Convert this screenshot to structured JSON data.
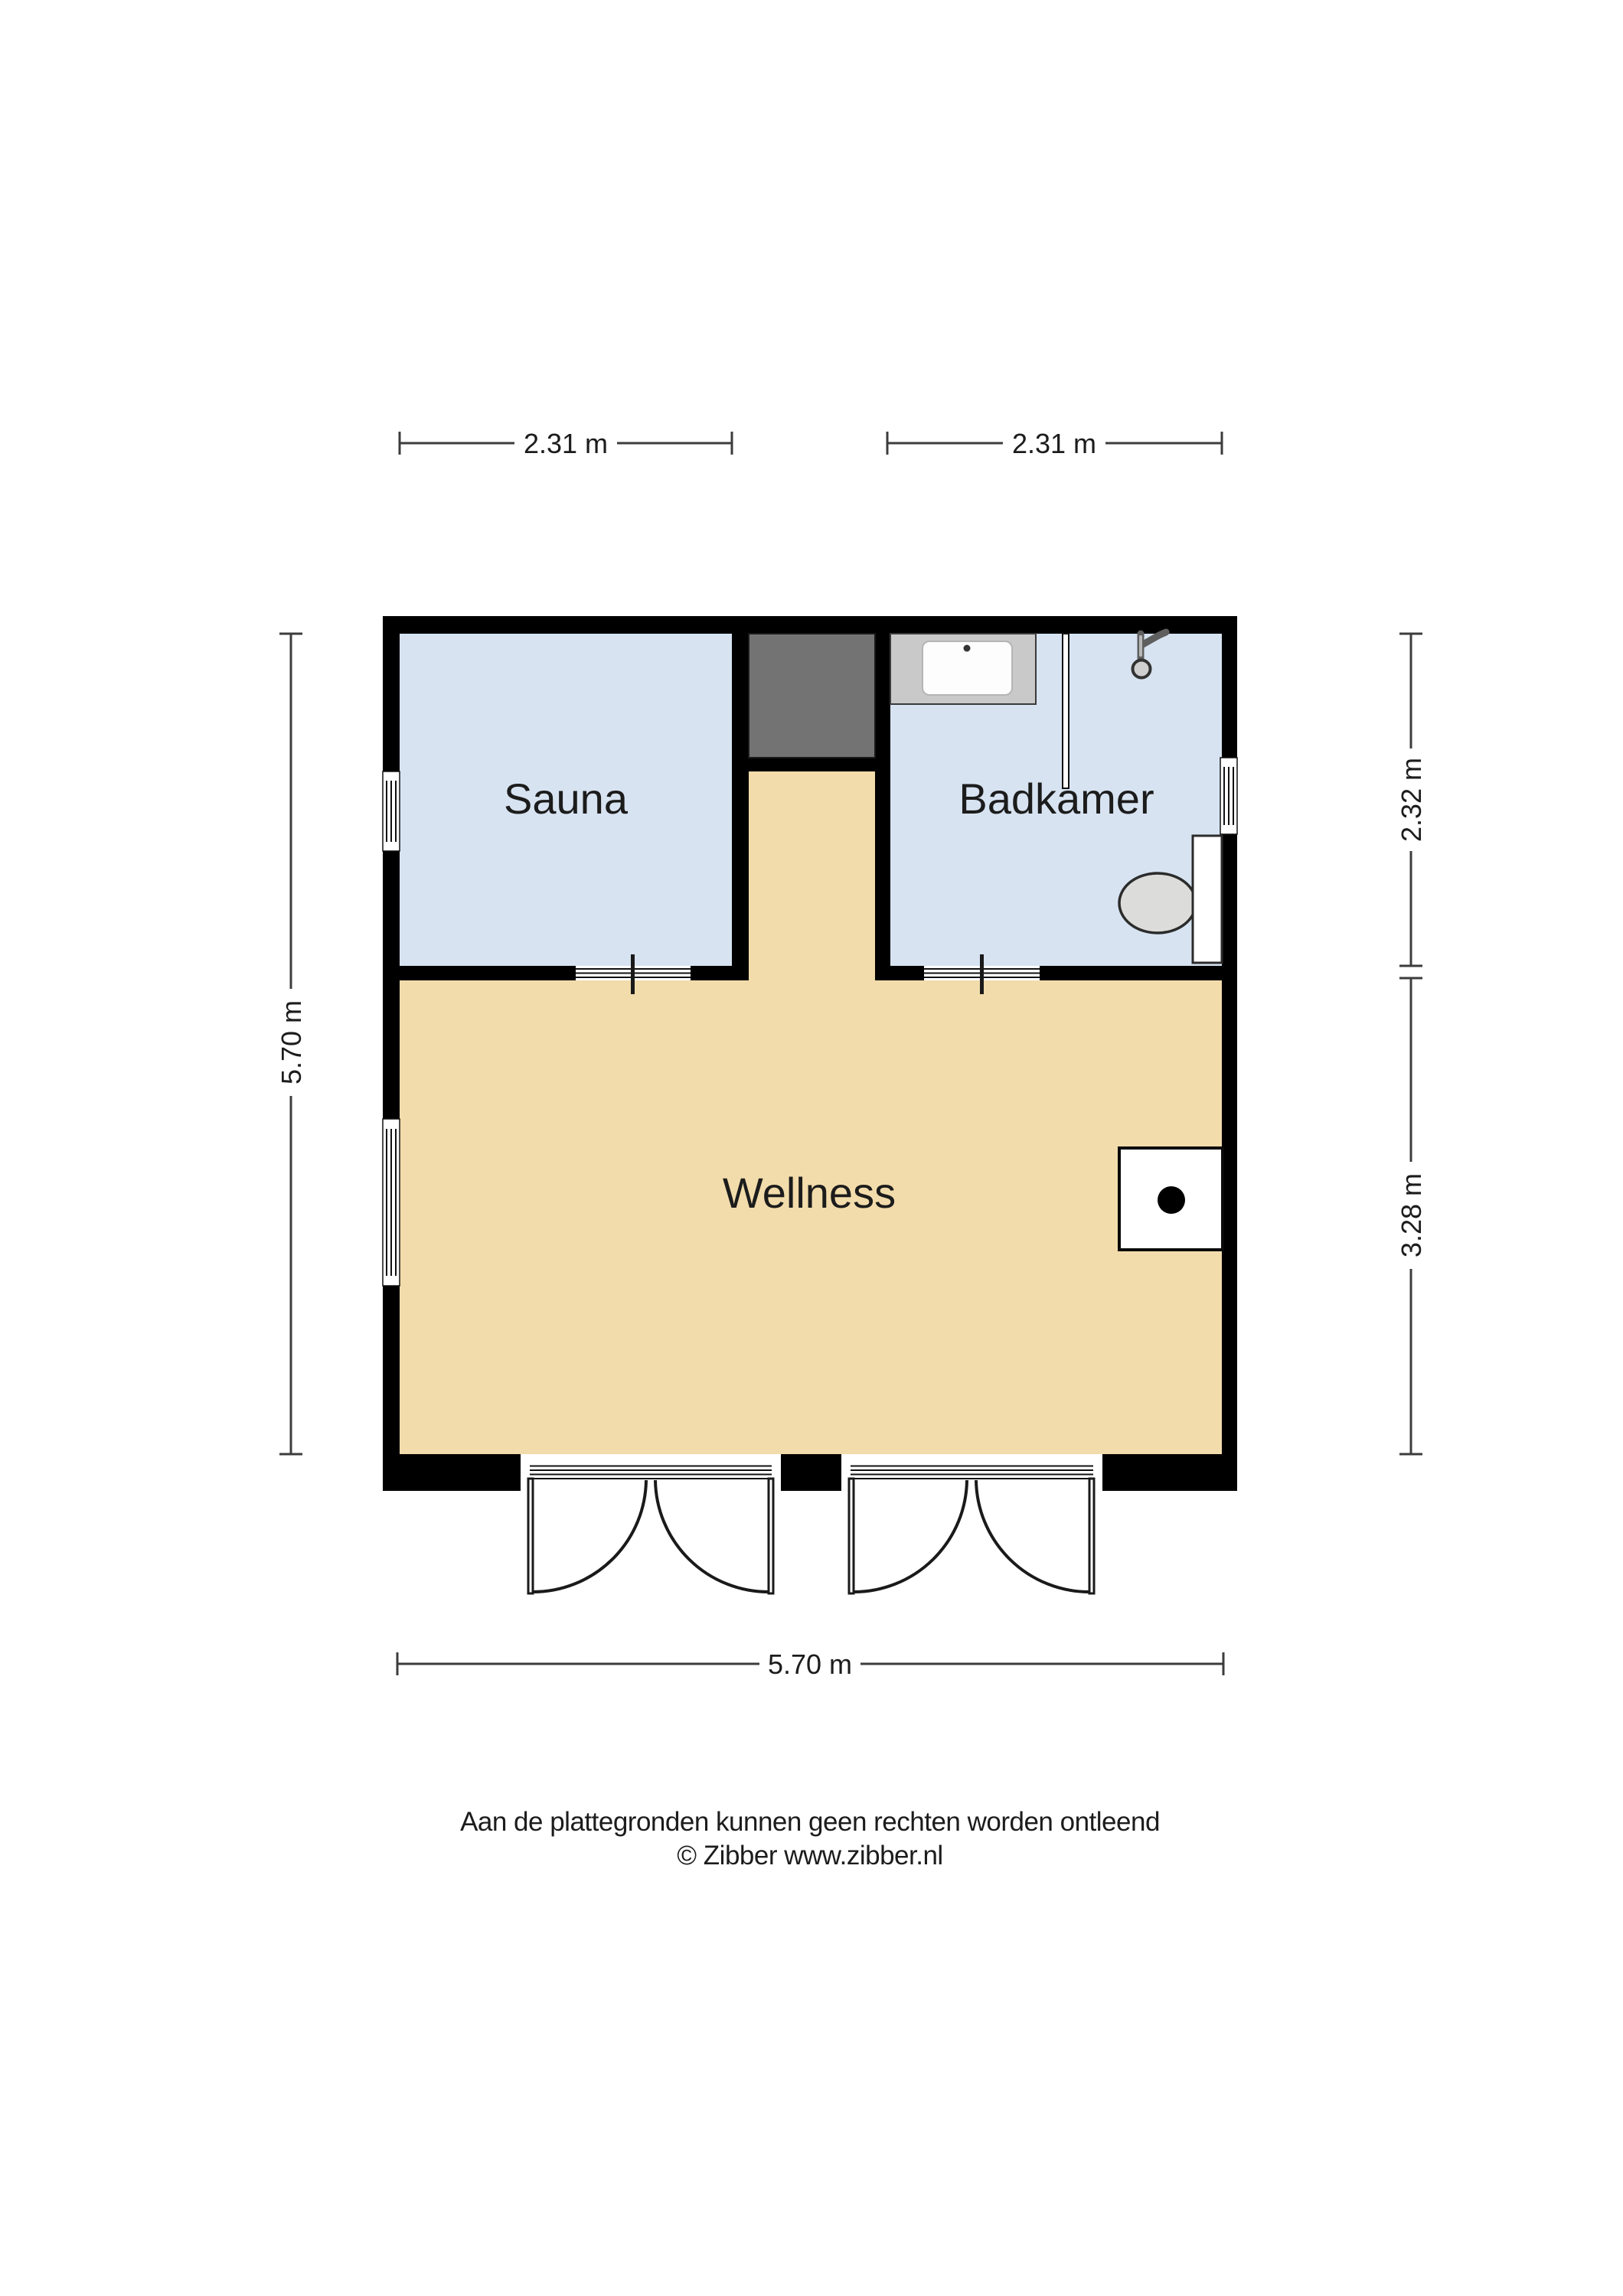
{
  "floorplan": {
    "rooms": [
      {
        "name": "sauna",
        "label": "Sauna"
      },
      {
        "name": "badkamer",
        "label": "Badkamer"
      },
      {
        "name": "wellness",
        "label": "Wellness"
      }
    ],
    "dimensions": {
      "top_left": "2.31 m",
      "top_right": "2.31 m",
      "left": "5.70 m",
      "right_top": "2.32 m",
      "right_bottom": "3.28 m",
      "bottom": "5.70 m"
    },
    "fixtures": [
      "shower-tray",
      "shower-head",
      "shower-screen",
      "toilet",
      "stove",
      "chimney",
      "window",
      "double-door",
      "door-opening"
    ],
    "colors": {
      "wall": "#000000",
      "room_blue": "#d7e3f1",
      "room_tan": "#f2dcab",
      "chimney_gray": "#737373",
      "fixture_gray": "#c9c9c9",
      "dim_line": "#3c3c3c",
      "text": "#1c1c1c"
    },
    "footer": {
      "disclaimer": "Aan de plattegronden kunnen geen rechten worden ontleend",
      "copyright": "© Zibber www.zibber.nl"
    }
  }
}
